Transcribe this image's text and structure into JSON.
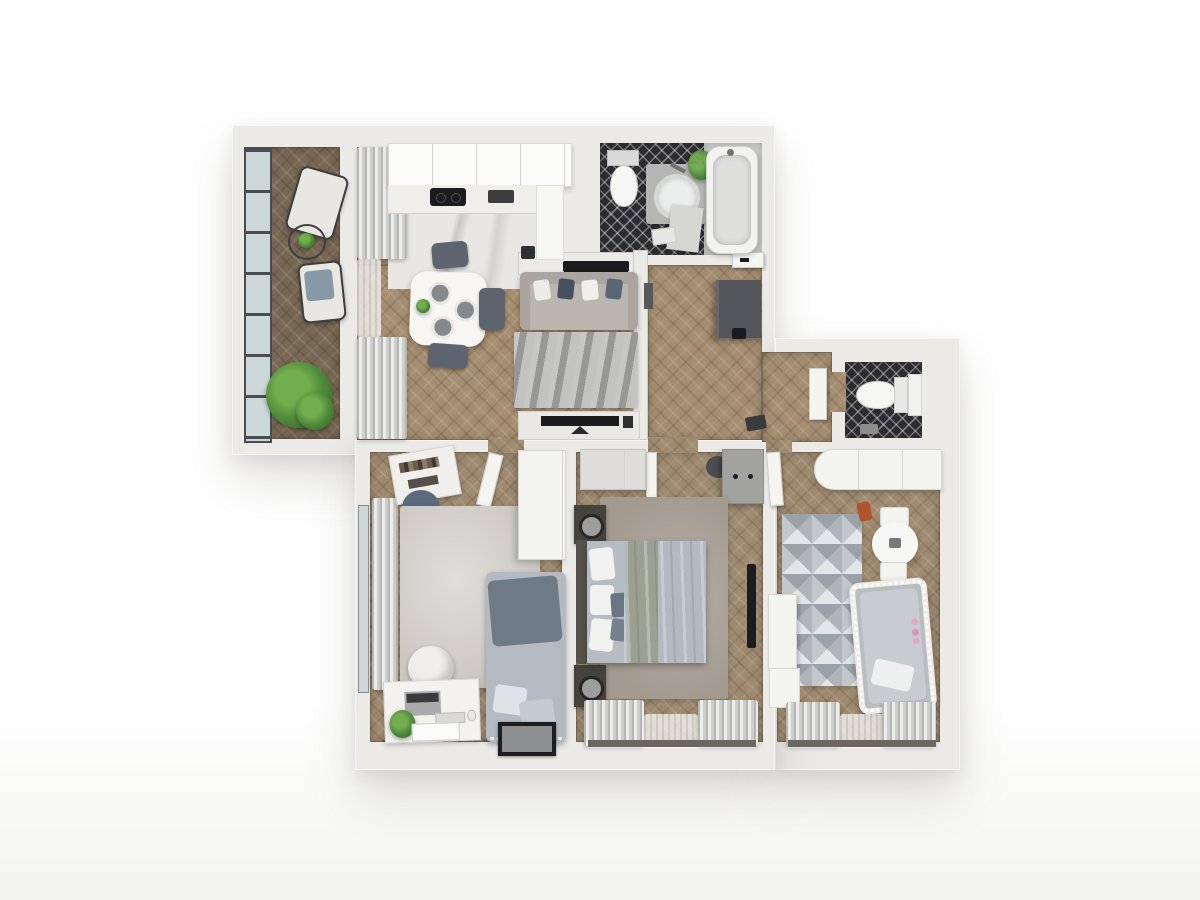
{
  "meta": {
    "kind": "3d-rendered apartment floor plan, top-down view",
    "canvas": {
      "width": 1200,
      "height": 900
    },
    "visible_text": "none"
  },
  "palette": {
    "background": "#ffffff",
    "wall": "#ebeae7",
    "wood_balcony": "#786753",
    "wood_main": "#a58d71",
    "wood_rooms": "#9f8a6f",
    "marble": "#e8e7e3",
    "tile_black": "#2d2d31",
    "glass": "#ccd7d9",
    "rug_nook": "#a7a7a5",
    "rug_office": "#cbc8c2",
    "rug_bedroom": "#a39a90",
    "sofa_greige": "#b9b5af",
    "duvet": "#b2b9c2",
    "blanket": "#9aa191",
    "dark_wood": "#46423c",
    "anthracite": "#54565a",
    "plant": "#4f8a3b",
    "white_furn": "#f4f4f1",
    "black": "#1b1c1e"
  },
  "rooms": [
    {
      "id": "balcony",
      "label": "Balcony with two armchairs, wire table and potted plants",
      "floor": "dark herringbone wood, glazed wall"
    },
    {
      "id": "kitchen-dining",
      "label": "Kitchen and dining room with white cabinets, cooktop, dining table and chairs",
      "floor": "herringbone wood and marble"
    },
    {
      "id": "lounge-nook",
      "label": "Lounge nook with sofa, gray rug and TV bench",
      "floor": "wood with gray rug"
    },
    {
      "id": "bathroom",
      "label": "Bathroom with toilet, round-sink vanity, plant and bathtub",
      "floor": "black diamond-pattern tile"
    },
    {
      "id": "hallway",
      "label": "Hallway with dark entry wardrobe and bathroom door",
      "floor": "herringbone wood"
    },
    {
      "id": "wc",
      "label": "Separate WC with wall-hung toilet",
      "floor": "black diamond-pattern tile"
    },
    {
      "id": "office",
      "label": "Office / guest room with daybed, desk, chair, pouf and shelf",
      "floor": "herringbone wood with light rug"
    },
    {
      "id": "bedroom",
      "label": "Bedroom with double bed, nightstands with lamps, wardrobes and wall TV",
      "floor": "herringbone wood with rug"
    },
    {
      "id": "nursery",
      "label": "Nursery with crib with string lights, play table, triangle rug and wardrobe",
      "floor": "herringbone wood"
    }
  ],
  "furniture": {
    "balcony": [
      "armchair",
      "armchair with gray seat",
      "wire coffee table with plant",
      "large potted plant"
    ],
    "kitchen_dining": [
      "white upper cabinets",
      "black cooktop",
      "dark sink module",
      "L-counter",
      "white dining table with dark plates and vase",
      "three dark chairs",
      "floor-length curtains"
    ],
    "lounge_nook": [
      "half wall with black shelf",
      "greige three-seat sofa with mixed pillows",
      "gray marbled rug",
      "TV on light bench"
    ],
    "bathroom": [
      "toilet with tank",
      "gray vanity with round white basin",
      "green plant",
      "bathtub",
      "gray mat",
      "towel stool"
    ],
    "hallway": [
      "dark entry wardrobe",
      "black bag",
      "recessed white bathroom door with dark handle",
      "shoes",
      "open WC door leaf"
    ],
    "wc": [
      "wall-hung toilet",
      "white cistern panel",
      "small accessory"
    ],
    "office": [
      "window curtains on left wall",
      "angled ladder shelf",
      "navy pouf",
      "light gray rug",
      "gray daybed with throw and pillows",
      "white desk with laptop, keyboard, mouse, plant and drawers",
      "white round chair",
      "dark floor picture frame",
      "white wardrobe",
      "open white door"
    ],
    "bedroom": [
      "light wardrobe",
      "gray dresser with knobs",
      "dark chair",
      "dark nightstand with lamp (x2)",
      "double bed with white and gray pillows, gray-blue duvet, sage blanket",
      "taupe rug",
      "wall-mounted TV",
      "striped window curtains",
      "open white door"
    ],
    "nursery": [
      "white curved wardrobe",
      "triangle-pattern rug",
      "orange toy car",
      "round play table with two white stools",
      "white crib with string lights and pink garland",
      "white storage cabinets",
      "striped window curtains",
      "open white door"
    ]
  }
}
